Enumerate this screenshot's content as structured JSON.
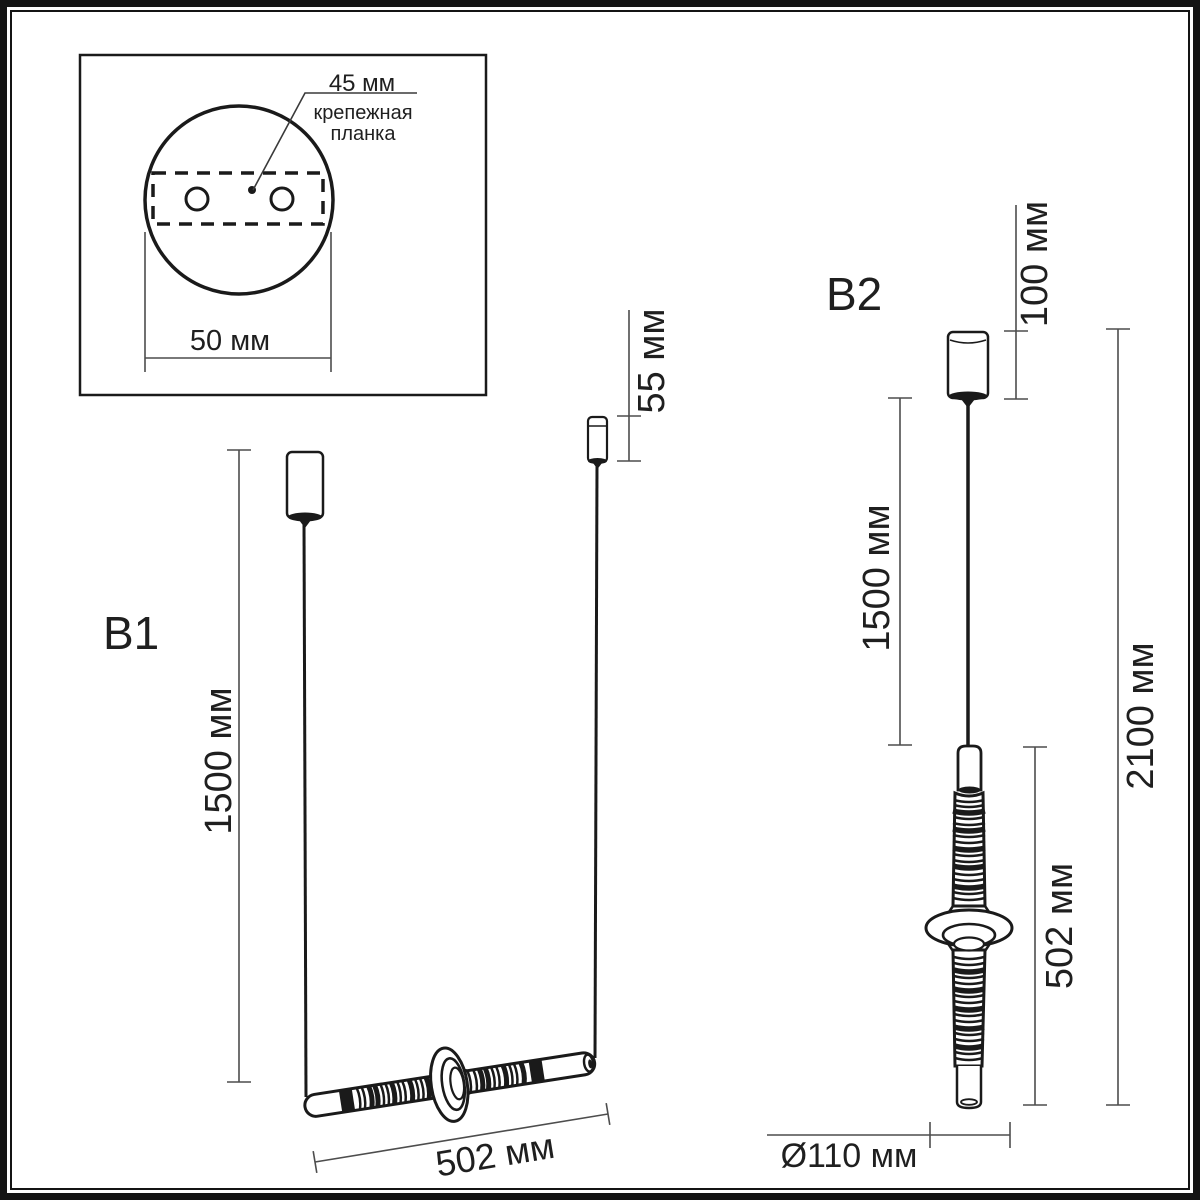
{
  "drawing": {
    "inset": {
      "hole_spacing": "45 мм",
      "plate_name_line1": "крепежная",
      "plate_name_line2": "планка",
      "plate_width": "50 мм"
    },
    "variant_b1": {
      "label": "B1",
      "suspension_height": "1500 мм",
      "canopy_height": "55 мм",
      "lamp_length": "502 мм"
    },
    "variant_b2": {
      "label": "B2",
      "canopy_height": "100 мм",
      "suspension_height": "1500 мм",
      "total_height": "2100 мм",
      "lamp_length": "502 мм",
      "shade_diameter": "Ø110 мм"
    }
  },
  "colors": {
    "outline": "#1a1a1a",
    "dimension": "#4d4d4d",
    "background": "#ffffff"
  }
}
